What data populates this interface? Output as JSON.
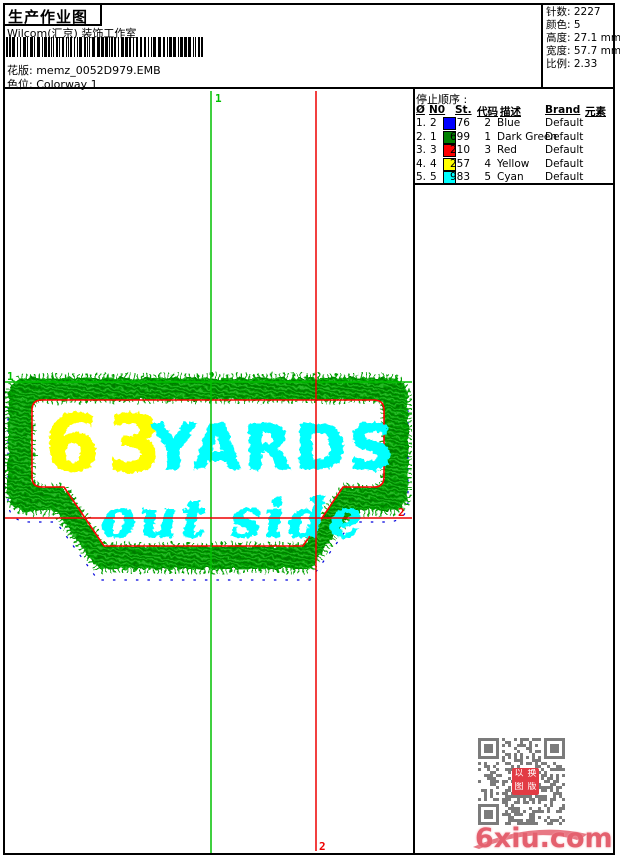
{
  "header": {
    "title": "生产作业图",
    "studio": "Wilcom(汇京) 装饰工作室",
    "design_label": "花版:",
    "design_value": "memz_0052D979.EMB",
    "colorway_label": "色位:",
    "colorway_value": "Colorway 1"
  },
  "stats": {
    "rows": [
      {
        "label": "针数:",
        "value": "2227"
      },
      {
        "label": "颜色:",
        "value": "5"
      },
      {
        "label": "高度:",
        "value": "27.1 mm"
      },
      {
        "label": "宽度:",
        "value": "57.7 mm"
      },
      {
        "label": "比例:",
        "value": "2.33"
      }
    ]
  },
  "stop_sequence": {
    "title": "停止顺序 :",
    "columns": [
      "Ø",
      "N0",
      "St.",
      "代码",
      "描述",
      "Brand",
      "元素"
    ],
    "rows": [
      {
        "index": "1.",
        "n0": "2",
        "color": "#0000ff",
        "st": "76",
        "code": "2",
        "desc": "Blue",
        "brand": "Default"
      },
      {
        "index": "2.",
        "n0": "1",
        "color": "#008000",
        "st": "699",
        "code": "1",
        "desc": "Dark Green",
        "brand": "Default"
      },
      {
        "index": "3.",
        "n0": "3",
        "color": "#ff0000",
        "st": "210",
        "code": "3",
        "desc": "Red",
        "brand": "Default"
      },
      {
        "index": "4.",
        "n0": "4",
        "color": "#ffff00",
        "st": "257",
        "code": "4",
        "desc": "Yellow",
        "brand": "Default"
      },
      {
        "index": "5.",
        "n0": "5",
        "color": "#00ffff",
        "st": "983",
        "code": "5",
        "desc": "Cyan",
        "brand": "Default"
      }
    ]
  },
  "design": {
    "text_numbers": "63",
    "text_word": "YARDS",
    "text_bottom": "out side",
    "colors": {
      "border": "#00a000",
      "outline": "#ff0000",
      "numbers": "#ffff00",
      "letters": "#00ffff",
      "underlay": "#0000dd"
    },
    "markers": {
      "start_label": "1",
      "end_label": "2",
      "start_color": "#00c000",
      "end_color": "#ee0000"
    }
  },
  "footer": {
    "watermark": "6xiu.com",
    "stamp_chars": [
      "以",
      "换",
      "图",
      "版"
    ]
  }
}
